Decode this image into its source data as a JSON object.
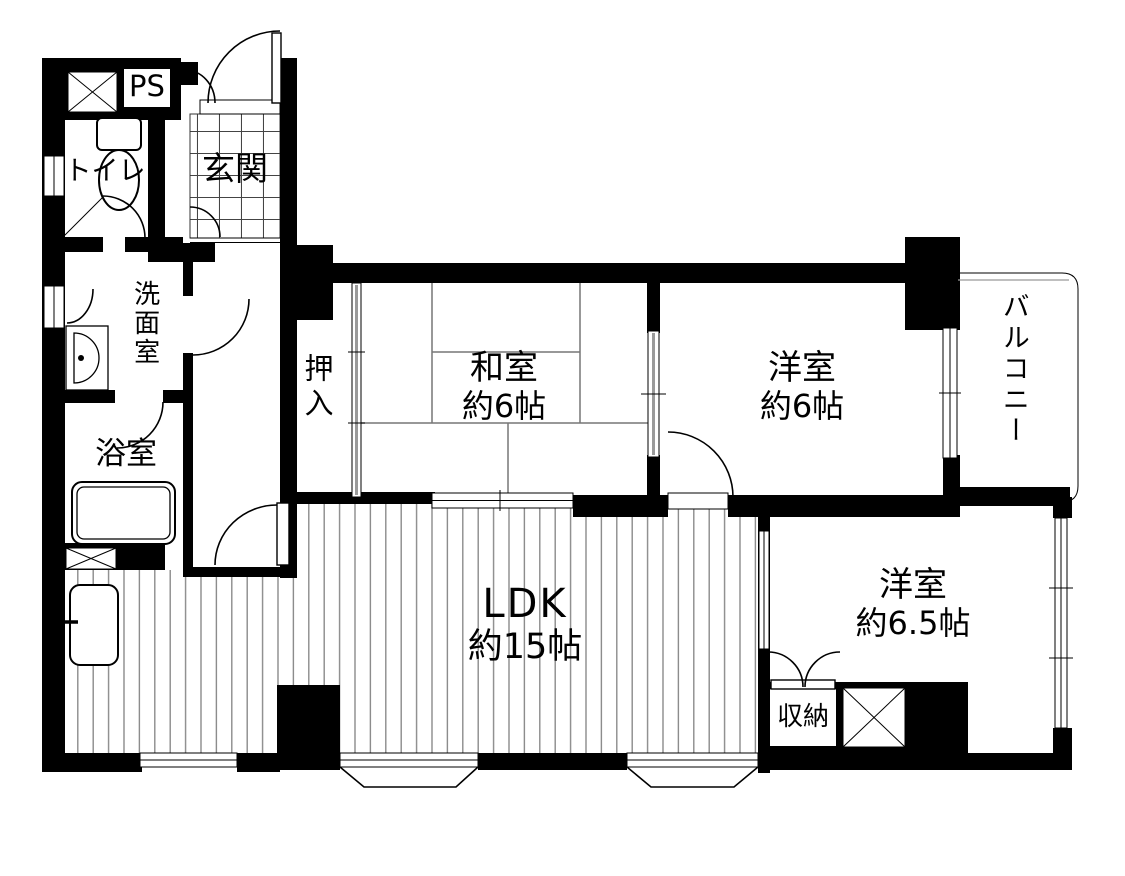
{
  "colors": {
    "wall": "#000000",
    "background": "#ffffff",
    "tatami_line": "#777777",
    "floor_line": "#8a8a8a",
    "tile_line": "#444444",
    "sliding_track": "#9a9a9a"
  },
  "rooms": {
    "ps": {
      "label": "PS"
    },
    "toilet": {
      "label": "トイレ"
    },
    "entrance": {
      "label": "玄関"
    },
    "washroom": {
      "label": "洗面室"
    },
    "bathroom": {
      "label": "浴室"
    },
    "oshiire": {
      "label": "押入"
    },
    "japanese_room": {
      "label": "和室",
      "size": "約6帖"
    },
    "western_room_6": {
      "label": "洋室",
      "size": "約6帖"
    },
    "balcony": {
      "label": "バルコニー"
    },
    "ldk": {
      "label": "LDK",
      "size": "約15帖"
    },
    "western_room_6_5": {
      "label": "洋室",
      "size": "約6.5帖"
    },
    "storage": {
      "label": "収納"
    }
  }
}
